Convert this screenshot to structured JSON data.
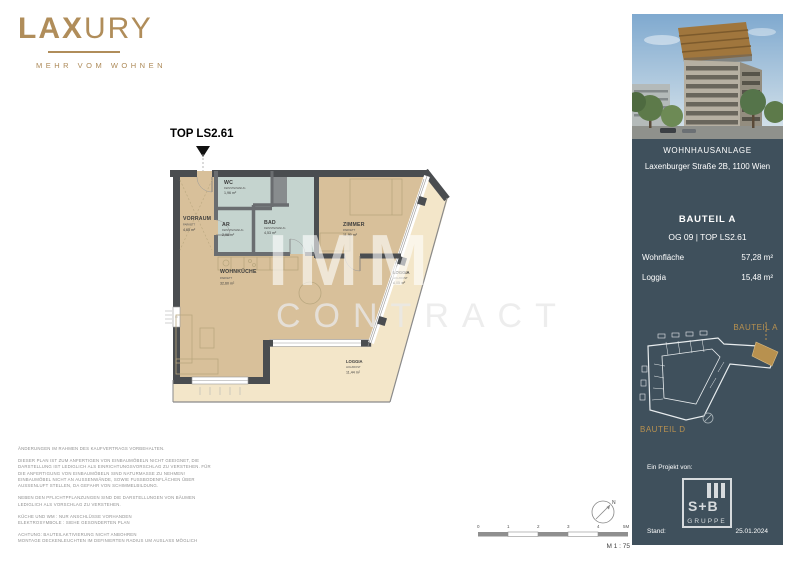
{
  "brand": {
    "logo_bold": "LAX",
    "logo_light": "URY",
    "tagline": "MEHR VOM WOHNEN"
  },
  "plan": {
    "unit_label": "TOP LS2.61",
    "watermark_line1": "IMMO",
    "watermark_line2": "CONTRACT",
    "rooms": [
      {
        "name": "VORRAUM",
        "floor": "PARKETT",
        "area": "4,65 m²"
      },
      {
        "name": "WC",
        "floor": "FEINSTEINZEUG",
        "area": "1,96 m²"
      },
      {
        "name": "AR",
        "floor": "FEINSTEINZEUG",
        "area": "2,98 m²"
      },
      {
        "name": "BAD",
        "floor": "FEINSTEINZEUG",
        "area": "4,53 m²"
      },
      {
        "name": "ZIMMER",
        "floor": "PARKETT",
        "area": "11,90 m²"
      },
      {
        "name": "WOHNKÜCHE",
        "floor": "PARKETT",
        "area": "32,60 m²"
      },
      {
        "name": "LOGGIA",
        "floor": "HOLZROST",
        "area": "4,05 m²"
      },
      {
        "name": "LOGGIA",
        "floor": "HOLZROST",
        "area": "11,44 m²"
      }
    ]
  },
  "scale": {
    "ticks": [
      "0",
      "1",
      "2",
      "3",
      "4",
      "5M"
    ],
    "label": "M 1 : 75",
    "north": "N"
  },
  "sidebar": {
    "project": {
      "title": "WOHNHAUSANLAGE",
      "address": "Laxenburger Straße 2B, 1100 Wien"
    },
    "unit": {
      "bauteil": "BAUTEIL A",
      "floor_top": "OG 09 | TOP LS2.61",
      "rows": [
        {
          "label": "Wohnfläche",
          "value": "57,28 m²"
        },
        {
          "label": "Loggia",
          "value": "15,48 m²"
        }
      ]
    },
    "siteplan": {
      "label_a": "BAUTEIL A",
      "label_d": "BAUTEIL D"
    },
    "project_by": "Ein Projekt von:",
    "logo": {
      "line1": "S+B",
      "line2": "GRUPPE"
    },
    "stand_label": "Stand:",
    "stand_date": "25.01.2024"
  },
  "disclaimer": {
    "p1": "ÄNDERUNGEN IM RAHMEN DES KAUFVERTRAGS VORBEHALTEN.",
    "p2": "DIESER PLAN IST ZUM ANFERTIGEN VON EINBAUMÖBELN NICHT GEEIGNET, DIE\nDARSTELLUNG IST LEDIGLICH ALS EINRICHTUNGSVORSCHLAG ZU VERSTEHEN. FÜR\nDIE ANFERTIGUNG VON EINBAUMÖBELN SIND NATURMASSE ZU NEHMEN!\nEINBAUMÖBEL NICHT AN AUSSENWÄNDE, SOWIE FUSSBODENFLÄCHEN ÜBER\nAUSSENLUFT STELLEN, DA GEFAHR VON SCHIMMELBILDUNG.",
    "p3": "NEBEN DEN PFLICHTPFLANZUNGEN SIND DIE DARSTELLUNGEN VON BÄUMEN\nLEDIGLICH ALS VORSCHLAG ZU VERSTEHEN.",
    "p4": "KÜCHE UND WM : NUR ANSCHLÜSSE VORHANDEN\nELEKTROSYMBOLE : SIEHE GESONDERTEN PLAN",
    "p5": "ACHTUNG: BAUTEILAKTIVIERUNG NICHT ANBOHREN\nMONTAGE DECKENLEUCHTEN IM DEFINIERTEN RADIUS UM AUSLASS MÖGLICH"
  },
  "colors": {
    "accent_gold": "#b08d5a",
    "sidebar_bg": "#3f505c",
    "room_parkett": "#d8c09a",
    "room_wet": "#c5d4cf",
    "loggia": "#f3e6c9",
    "wall": "#4a4d50"
  }
}
